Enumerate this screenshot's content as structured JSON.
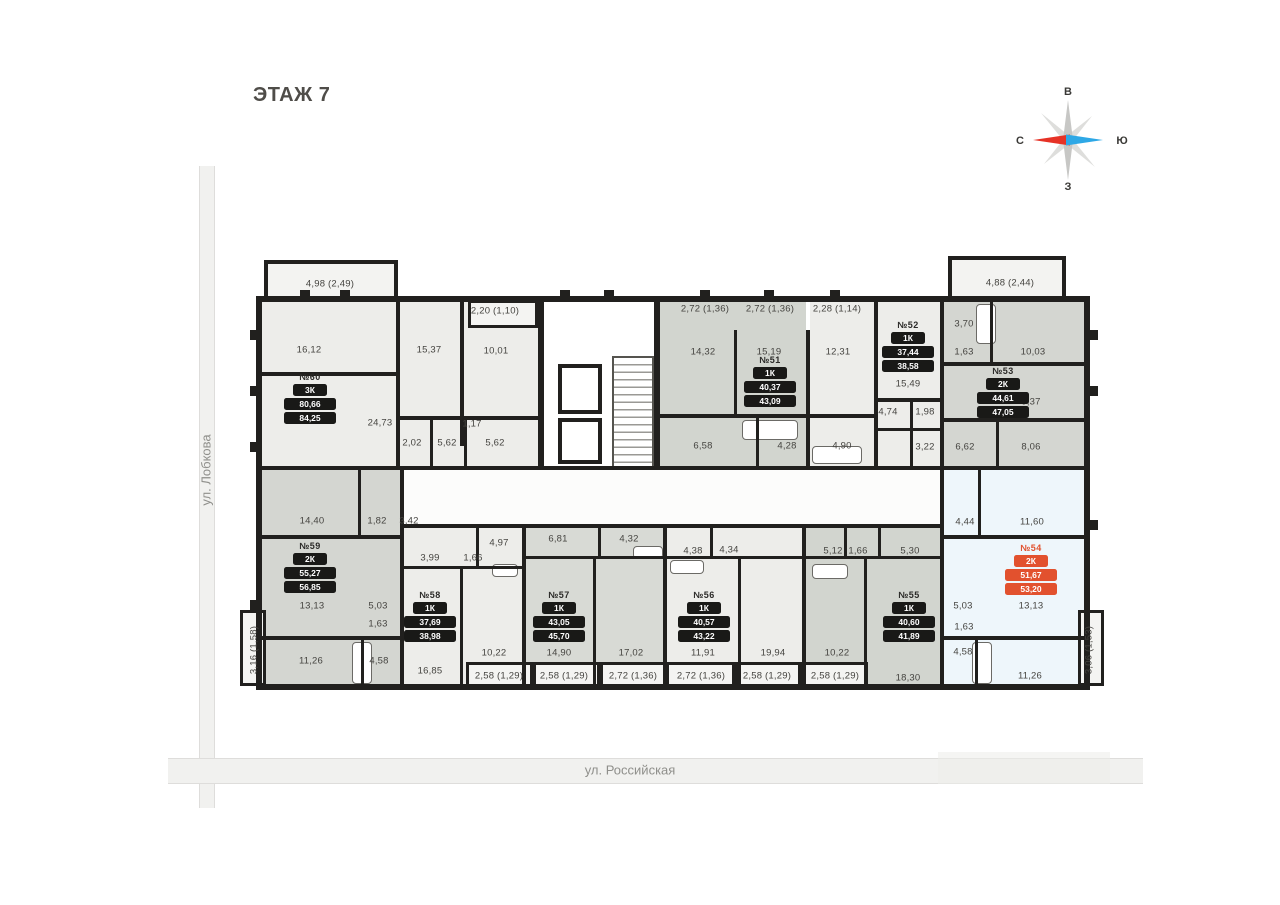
{
  "title": "ЭТАЖ 7",
  "compass": {
    "top": "В",
    "right": "Ю",
    "left": "С",
    "bottom": "З"
  },
  "streets": {
    "left": "ул. Лобкова",
    "bottom": "ул. Российская"
  },
  "accent_color": "#e2512e",
  "apartments": [
    {
      "id": "60",
      "label": "№60",
      "type": "3К",
      "area1": "80,66",
      "area2": "84,25",
      "x": 310,
      "y": 372,
      "highlight": false
    },
    {
      "id": "59",
      "label": "№59",
      "type": "2К",
      "area1": "55,27",
      "area2": "56,85",
      "x": 310,
      "y": 541,
      "highlight": false
    },
    {
      "id": "58",
      "label": "№58",
      "type": "1К",
      "area1": "37,69",
      "area2": "38,98",
      "x": 430,
      "y": 590,
      "highlight": false
    },
    {
      "id": "57",
      "label": "№57",
      "type": "1К",
      "area1": "43,05",
      "area2": "45,70",
      "x": 559,
      "y": 590,
      "highlight": false
    },
    {
      "id": "56",
      "label": "№56",
      "type": "1К",
      "area1": "40,57",
      "area2": "43,22",
      "x": 704,
      "y": 590,
      "highlight": false
    },
    {
      "id": "55",
      "label": "№55",
      "type": "1К",
      "area1": "40,60",
      "area2": "41,89",
      "x": 909,
      "y": 590,
      "highlight": false
    },
    {
      "id": "54",
      "label": "№54",
      "type": "2К",
      "area1": "51,67",
      "area2": "53,20",
      "x": 1031,
      "y": 543,
      "highlight": true
    },
    {
      "id": "53",
      "label": "№53",
      "type": "2К",
      "area1": "44,61",
      "area2": "47,05",
      "x": 1003,
      "y": 366,
      "highlight": false
    },
    {
      "id": "52",
      "label": "№52",
      "type": "1К",
      "area1": "37,44",
      "area2": "38,58",
      "x": 908,
      "y": 320,
      "highlight": false
    },
    {
      "id": "51",
      "label": "№51",
      "type": "1К",
      "area1": "40,37",
      "area2": "43,09",
      "x": 770,
      "y": 355,
      "highlight": false
    }
  ],
  "room_labels": [
    {
      "t": "4,98 (2,49)",
      "x": 330,
      "y": 284
    },
    {
      "t": "2,20 (1,10)",
      "x": 495,
      "y": 311
    },
    {
      "t": "16,12",
      "x": 309,
      "y": 350
    },
    {
      "t": "15,37",
      "x": 429,
      "y": 350
    },
    {
      "t": "10,01",
      "x": 496,
      "y": 351
    },
    {
      "t": "24,73",
      "x": 380,
      "y": 423
    },
    {
      "t": "2,02",
      "x": 412,
      "y": 443
    },
    {
      "t": "5,62",
      "x": 447,
      "y": 443
    },
    {
      "t": "1,17",
      "x": 472,
      "y": 424
    },
    {
      "t": "5,62",
      "x": 495,
      "y": 443
    },
    {
      "t": "2,72 (1,36)",
      "x": 705,
      "y": 309
    },
    {
      "t": "2,72 (1,36)",
      "x": 770,
      "y": 309
    },
    {
      "t": "2,28 (1,14)",
      "x": 837,
      "y": 309
    },
    {
      "t": "14,32",
      "x": 703,
      "y": 352
    },
    {
      "t": "15,19",
      "x": 769,
      "y": 352
    },
    {
      "t": "12,31",
      "x": 838,
      "y": 352
    },
    {
      "t": "6,58",
      "x": 703,
      "y": 446
    },
    {
      "t": "4,28",
      "x": 787,
      "y": 446
    },
    {
      "t": "4,90",
      "x": 842,
      "y": 446
    },
    {
      "t": "3,70",
      "x": 964,
      "y": 324
    },
    {
      "t": "1,63",
      "x": 964,
      "y": 352
    },
    {
      "t": "10,03",
      "x": 1033,
      "y": 352
    },
    {
      "t": "15,49",
      "x": 908,
      "y": 384
    },
    {
      "t": "4,74",
      "x": 888,
      "y": 412
    },
    {
      "t": "1,98",
      "x": 925,
      "y": 412
    },
    {
      "t": "9,37",
      "x": 1031,
      "y": 402
    },
    {
      "t": "3,22",
      "x": 925,
      "y": 447
    },
    {
      "t": "6,62",
      "x": 965,
      "y": 447
    },
    {
      "t": "8,06",
      "x": 1031,
      "y": 447
    },
    {
      "t": "4,88 (2,44)",
      "x": 1010,
      "y": 283
    },
    {
      "t": "14,40",
      "x": 312,
      "y": 521
    },
    {
      "t": "1,82",
      "x": 377,
      "y": 521
    },
    {
      "t": "3,42",
      "x": 409,
      "y": 521
    },
    {
      "t": "3,99",
      "x": 430,
      "y": 558
    },
    {
      "t": "1,66",
      "x": 473,
      "y": 558
    },
    {
      "t": "13,13",
      "x": 312,
      "y": 606
    },
    {
      "t": "5,03",
      "x": 378,
      "y": 606
    },
    {
      "t": "1,63",
      "x": 378,
      "y": 624
    },
    {
      "t": "11,26",
      "x": 311,
      "y": 661
    },
    {
      "t": "4,58",
      "x": 379,
      "y": 661
    },
    {
      "t": "16,85",
      "x": 430,
      "y": 671
    },
    {
      "t": "4,97",
      "x": 499,
      "y": 543
    },
    {
      "t": "6,81",
      "x": 558,
      "y": 539
    },
    {
      "t": "4,32",
      "x": 629,
      "y": 539
    },
    {
      "t": "4,38",
      "x": 693,
      "y": 551
    },
    {
      "t": "4,34",
      "x": 729,
      "y": 550
    },
    {
      "t": "10,22",
      "x": 494,
      "y": 653
    },
    {
      "t": "14,90",
      "x": 559,
      "y": 653
    },
    {
      "t": "17,02",
      "x": 631,
      "y": 653
    },
    {
      "t": "11,91",
      "x": 703,
      "y": 653
    },
    {
      "t": "2,58 (1,29)",
      "x": 499,
      "y": 676
    },
    {
      "t": "2,58 (1,29)",
      "x": 564,
      "y": 676
    },
    {
      "t": "2,72 (1,36)",
      "x": 633,
      "y": 676
    },
    {
      "t": "2,72 (1,36)",
      "x": 701,
      "y": 676
    },
    {
      "t": "5,12",
      "x": 833,
      "y": 551
    },
    {
      "t": "1,66",
      "x": 858,
      "y": 551
    },
    {
      "t": "5,30",
      "x": 910,
      "y": 551
    },
    {
      "t": "19,94",
      "x": 773,
      "y": 653
    },
    {
      "t": "10,22",
      "x": 837,
      "y": 653
    },
    {
      "t": "18,30",
      "x": 908,
      "y": 678
    },
    {
      "t": "2,58 (1,29)",
      "x": 767,
      "y": 676
    },
    {
      "t": "2,58 (1,29)",
      "x": 835,
      "y": 676
    },
    {
      "t": "4,44",
      "x": 965,
      "y": 522
    },
    {
      "t": "11,60",
      "x": 1032,
      "y": 522
    },
    {
      "t": "5,03",
      "x": 963,
      "y": 606
    },
    {
      "t": "13,13",
      "x": 1031,
      "y": 606
    },
    {
      "t": "1,63",
      "x": 964,
      "y": 627
    },
    {
      "t": "4,58",
      "x": 963,
      "y": 652
    },
    {
      "t": "11,26",
      "x": 1030,
      "y": 676
    },
    {
      "t": "3,06 (1,53)",
      "x": 1089,
      "y": 650,
      "rot": -90
    },
    {
      "t": "3,16 (1,58)",
      "x": 254,
      "y": 650,
      "rot": -90
    }
  ]
}
